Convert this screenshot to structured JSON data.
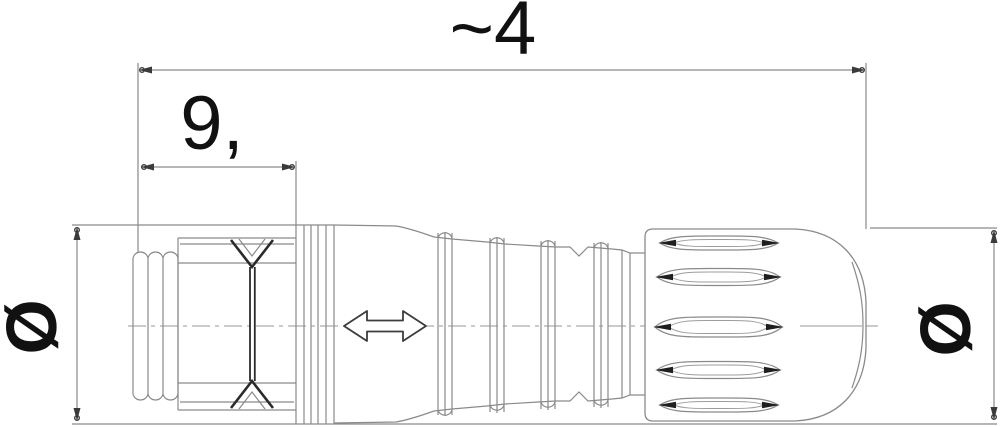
{
  "drawing": {
    "kind": "technical-dimension-drawing-connector-side-view",
    "labels": {
      "overall_length": "~4",
      "front_section_length": "9,",
      "diameter_left": "Ø",
      "diameter_right": "Ø"
    },
    "colors": {
      "outline": "#8a8a8a",
      "accent_dark": "#2b2b2b",
      "text": "#111111",
      "background": "#ffffff"
    }
  }
}
